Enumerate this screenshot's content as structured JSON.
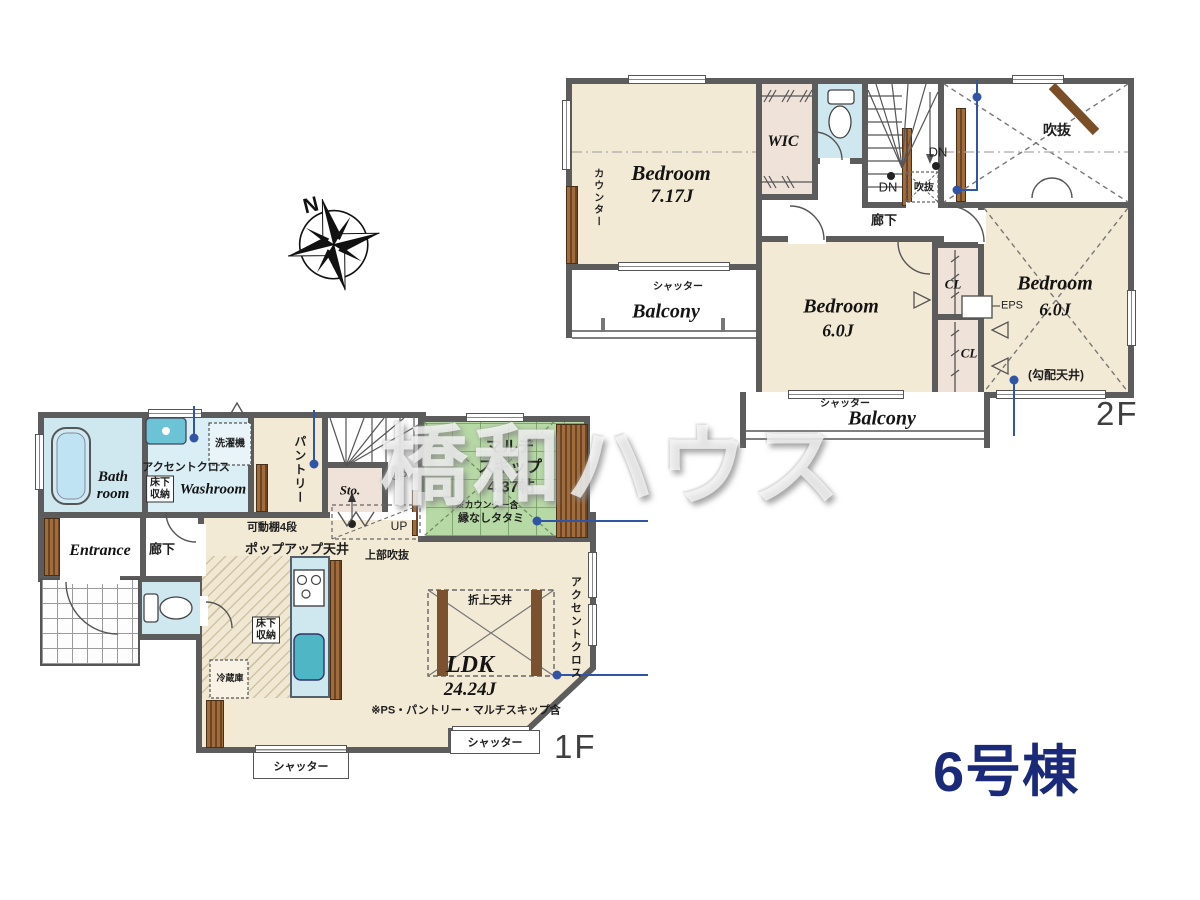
{
  "meta": {
    "building_label": "6号棟",
    "floor1_label": "1F",
    "floor2_label": "2F",
    "compass_north": "N",
    "watermark": "橋和ハウス",
    "colors": {
      "wall": "#5c5c5c",
      "room_cream": "#f3ead6",
      "tatami_green": "#b7d9a5",
      "water_blue": "#cfe8f0",
      "closet_pink": "#efe2d9",
      "annotation_blue": "#2f55a4",
      "building_navy": "#1b2a78"
    }
  },
  "f2": {
    "counter": "カウンター",
    "bedroom1_name": "Bedroom",
    "bedroom1_size": "7.17J",
    "wic": "WIC",
    "dn_a": "DN",
    "dn_b": "DN",
    "void_small": "吹抜",
    "void_large": "吹抜",
    "corridor": "廊下",
    "bedroom2_name": "Bedroom",
    "bedroom2_size": "6.0J",
    "cl_a": "CL",
    "cl_b": "CL",
    "eps": "EPS",
    "bedroom3_name": "Bedroom",
    "bedroom3_size": "6.0J",
    "bedroom3_note": "(勾配天井)",
    "balcony_a": "Balcony",
    "balcony_a_shutter": "シャッター",
    "balcony_b": "Balcony",
    "balcony_b_shutter": "シャッター"
  },
  "f1": {
    "bathroom": "Bath\nroom",
    "accent_a": "アクセントクロス",
    "underfloor_a": "床下\n収納",
    "washer": "洗濯機",
    "washroom": "Washroom",
    "pantry": "パントリー",
    "storage": "Sto.",
    "up_a": "UP",
    "up_b": "UP",
    "multiskip_name": "マルチ\nスキップ",
    "multiskip_size": "4.37帖",
    "multiskip_note1": "※カウンター含",
    "multiskip_note2": "縁なしタタミ",
    "shelf_note": "可動棚4段",
    "popup_note": "ポップアップ天井",
    "upper_void": "上部吹抜",
    "entrance": "Entrance",
    "corridor": "廊下",
    "fridge": "冷蔵庫",
    "underfloor_b": "床下\n収納",
    "coffered": "折上天井",
    "ldk_name": "LDK",
    "ldk_size": "24.24J",
    "ldk_note": "※PS・パントリー・マルチスキップ含",
    "accent_b": "アクセントクロス",
    "shutter_a": "シャッター",
    "shutter_b": "シャッター"
  }
}
